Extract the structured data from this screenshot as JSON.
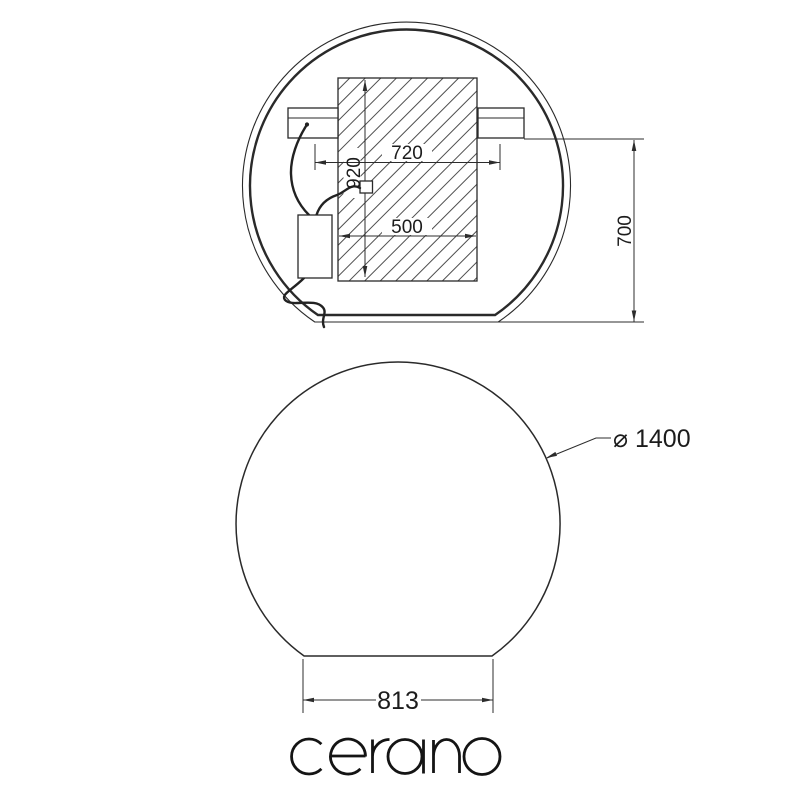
{
  "drawing": {
    "back_view": {
      "dim_bracket_spacing": "720",
      "dim_plate_height": "920",
      "dim_plate_width": "500",
      "dim_overall_height": "700"
    },
    "front_view": {
      "dim_diameter": "⌀ 1400",
      "dim_base_width": "813"
    },
    "brand": "cerano"
  },
  "colors": {
    "background": "#ffffff",
    "line": "#2a2a2a",
    "hatch": "#3a3a3a",
    "text": "#1c1c1c"
  }
}
